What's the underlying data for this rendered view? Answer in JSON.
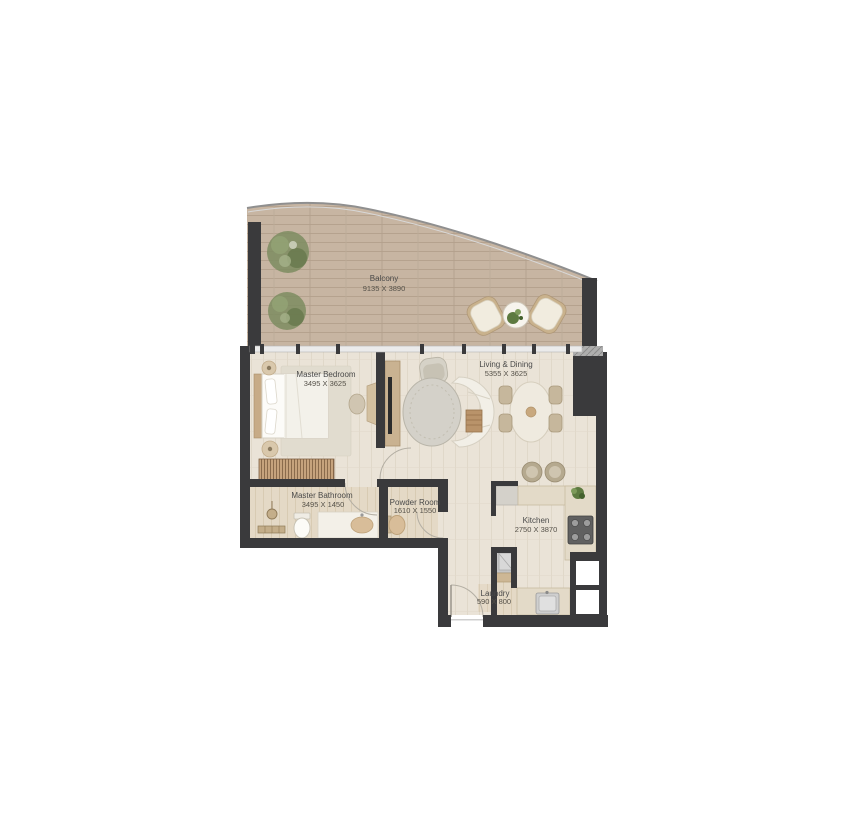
{
  "plan": {
    "type": "apartment-floor-plan",
    "background": "#ffffff"
  },
  "palette": {
    "wall": "#3a3a3c",
    "wall_hatch": "#a8a8a8",
    "balcony_floor": "#c7b5a2",
    "balcony_plank_line": "#b5a28e",
    "interior_floor": "#eae3d7",
    "interior_plank_line": "#ded5c6",
    "wet_room_floor": "#e4d9c6",
    "wood_accent": "#c9b291",
    "furniture_light": "#f2efe7",
    "greenery": "#6d7f52",
    "glass": "#ebebeb",
    "label_text": "#4a4a4a"
  },
  "rooms": [
    {
      "id": "balcony",
      "name": "Balcony",
      "dimensions": "9135 X 3890"
    },
    {
      "id": "master-bedroom",
      "name": "Master Bedroom",
      "dimensions": "3495 X 3625"
    },
    {
      "id": "living-dining",
      "name": "Living & Dining",
      "dimensions": "5355 X 3625"
    },
    {
      "id": "master-bathroom",
      "name": "Master Bathroom",
      "dimensions": "3495 X 1450"
    },
    {
      "id": "powder-room",
      "name": "Powder Room",
      "dimensions": "1610 X 1550"
    },
    {
      "id": "kitchen",
      "name": "Kitchen",
      "dimensions": "2750 X 3870"
    },
    {
      "id": "laundry",
      "name": "Laundry",
      "dimensions": "590 X 800"
    }
  ]
}
